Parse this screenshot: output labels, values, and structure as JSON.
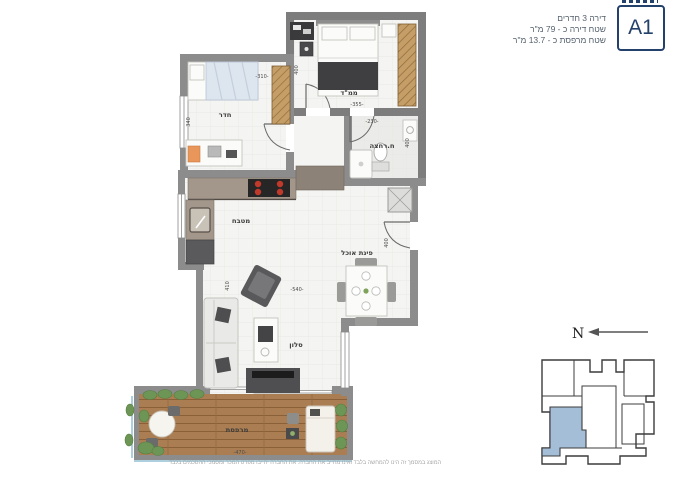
{
  "header": {
    "unit_label": "A1",
    "info_lines": [
      "דירה 3 חדרים",
      "שטח דירה כ - 79 מ\"ר",
      "שטח מרפסת כ - 13.7 מ\"ר"
    ]
  },
  "plan": {
    "rooms": {
      "mamad": "ממ\"ד",
      "bedroom": "חדר",
      "bathroom": "ח.רחצה",
      "kitchen": "מטבח",
      "dining": "פינת אוכל",
      "living": "סלון",
      "balcony": "מרפסת"
    },
    "dimensions": {
      "bedroom_width": "-310-",
      "bedroom_depth": "340",
      "mamad_depth": "400",
      "mamad_width": "-355-",
      "bathroom_width": "-230-",
      "bathroom_depth": "400",
      "living_depth": "410",
      "living_width": "-540-",
      "entry_depth": "400",
      "balcony_width": "-470-"
    }
  },
  "compass": {
    "north_label": "N"
  },
  "footer": {
    "disclaimer": "המוצג במסמך זה הינו להמחשה בלבד ואינו מחייב את החברה. את החברה יחייבו מפרט המכר ומסמכי ההסכמים בלבד"
  },
  "colors": {
    "accent_navy": "#24416b",
    "wall_gray": "#8c8c8c",
    "keyplan_highlight": "#a3bed6",
    "wood": "#c49e66",
    "deck": "#aa7e52",
    "plant_green": "#6d9555"
  }
}
